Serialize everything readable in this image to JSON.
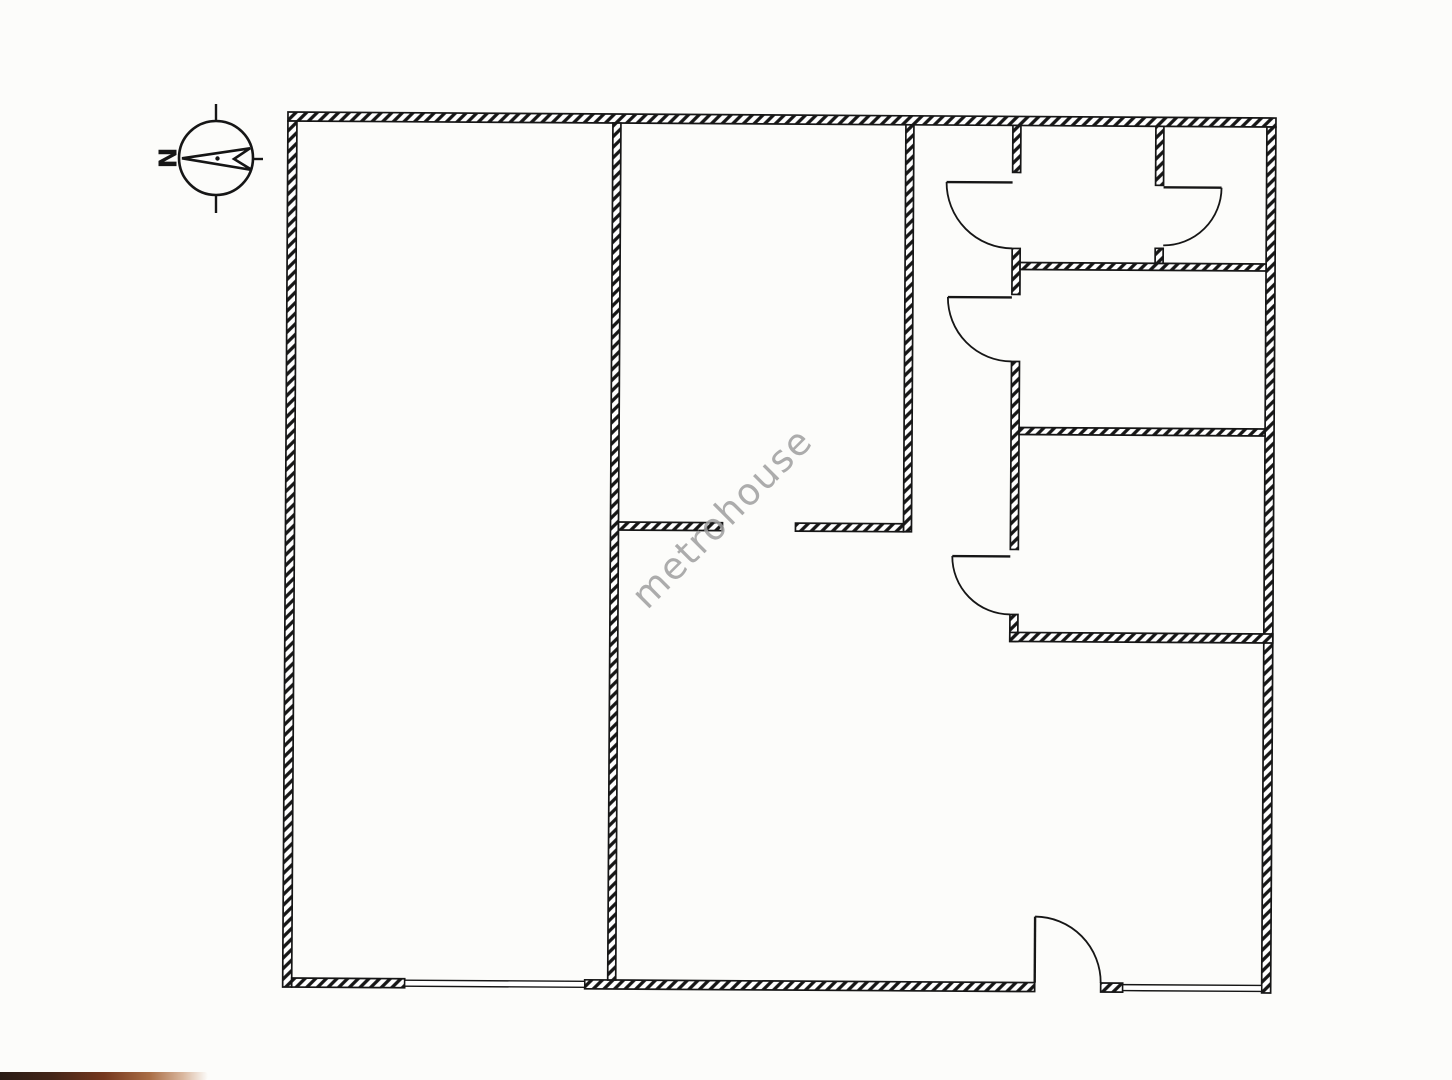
{
  "page": {
    "background": "#fcfcfa",
    "ink_color": "#161616"
  },
  "watermark": {
    "text": "metrohouse",
    "color": "#9f9f9f",
    "angle_deg": -45,
    "cx": 722,
    "cy": 518,
    "font_size": 37
  },
  "compass": {
    "letter": "N",
    "letter_x": 167,
    "letter_y": 158,
    "letter_size": 25,
    "cx": 216,
    "cy": 158,
    "r": 37,
    "ticks": [
      [
        216,
        104,
        216,
        121
      ],
      [
        216,
        195,
        216,
        213
      ],
      [
        253,
        159,
        263,
        159
      ]
    ],
    "arrow_points": "182,158.3 250,148.3 234,159 252,170",
    "center_dot": [
      217.5,
      158.5,
      2.2
    ]
  },
  "floorplan": {
    "tilt_deg": 0.35,
    "stroke": "#161616",
    "walls": [
      {
        "name": "wall-exterior-top",
        "x": 288,
        "y": 112,
        "w": 988,
        "h": 9
      },
      {
        "name": "wall-exterior-left",
        "x": 288,
        "y": 121,
        "w": 9,
        "h": 866
      },
      {
        "name": "wall-exterior-right",
        "x": 1267,
        "y": 121,
        "w": 9,
        "h": 866
      },
      {
        "name": "wall-exterior-bottom-a",
        "x": 297,
        "y": 978,
        "w": 113,
        "h": 9
      },
      {
        "name": "wall-exterior-bottom-b",
        "x": 590,
        "y": 978,
        "w": 450,
        "h": 9
      },
      {
        "name": "wall-exterior-bottom-c",
        "x": 1106,
        "y": 978,
        "w": 22,
        "h": 9
      },
      {
        "name": "wall-leftroom-right",
        "x": 613,
        "y": 121,
        "w": 8,
        "h": 857
      },
      {
        "name": "wall-midroom-right-corridor-left",
        "x": 906,
        "y": 121,
        "w": 8,
        "h": 407
      },
      {
        "name": "wall-corridor-right-a",
        "x": 1013,
        "y": 121,
        "w": 8,
        "h": 47
      },
      {
        "name": "wall-corridor-right-b",
        "x": 1013,
        "y": 244,
        "w": 8,
        "h": 46
      },
      {
        "name": "wall-corridor-right-c",
        "x": 1013,
        "y": 357,
        "w": 8,
        "h": 188
      },
      {
        "name": "wall-corridor-right-d",
        "x": 1013,
        "y": 610,
        "w": 8,
        "h": 27
      },
      {
        "name": "wall-toprooms-bottom",
        "x": 1021,
        "y": 258,
        "w": 246,
        "h": 7
      },
      {
        "name": "wall-topright-room-left-a",
        "x": 1156,
        "y": 121,
        "w": 8,
        "h": 59
      },
      {
        "name": "wall-topright-room-left-b",
        "x": 1156,
        "y": 243,
        "w": 8,
        "h": 15
      },
      {
        "name": "wall-roomA-roomB-divider",
        "x": 1021,
        "y": 423,
        "w": 246,
        "h": 7
      },
      {
        "name": "wall-roomB-bottom",
        "x": 1013,
        "y": 628,
        "w": 263,
        "h": 9
      },
      {
        "name": "wall-midroom-bottom-left-stub",
        "x": 621,
        "y": 520,
        "w": 104,
        "h": 8
      },
      {
        "name": "wall-midroom-bottom-right-stub",
        "x": 798,
        "y": 520,
        "w": 108,
        "h": 8
      }
    ],
    "windows": [
      {
        "name": "window-bottom-left",
        "x": 410,
        "y": 979.5,
        "w": 180,
        "h": 6
      },
      {
        "name": "window-bottom-right",
        "x": 1128,
        "y": 979.5,
        "w": 139,
        "h": 6
      }
    ],
    "doors": [
      {
        "name": "door-1-corridor-top",
        "leaf": [
          947,
          178,
          1013,
          178
        ],
        "arc": "M 947 178 A 66 66 0 0 0 1013 244"
      },
      {
        "name": "door-2-corridor-mid",
        "leaf": [
          949,
          293,
          1013,
          293
        ],
        "arc": "M 949 293 A 64 64 0 0 0 1013 357"
      },
      {
        "name": "door-3-corridor-low",
        "leaf": [
          955,
          552,
          1013,
          552
        ],
        "arc": "M 955 552 A 58 58 0 0 0 1013 610"
      },
      {
        "name": "door-4-topright-room",
        "leaf": [
          1164,
          182,
          1222,
          182
        ],
        "arc": "M 1222 182 A 58 58 0 0 1 1164 240"
      },
      {
        "name": "door-5-bottom-entry",
        "leaf": [
          1040,
          912,
          1040,
          978
        ],
        "arc": "M 1040 912 A 66 66 0 0 1 1106 978"
      }
    ]
  },
  "artifacts": {
    "bottom_left_strip": "scan-edge-shadow"
  }
}
